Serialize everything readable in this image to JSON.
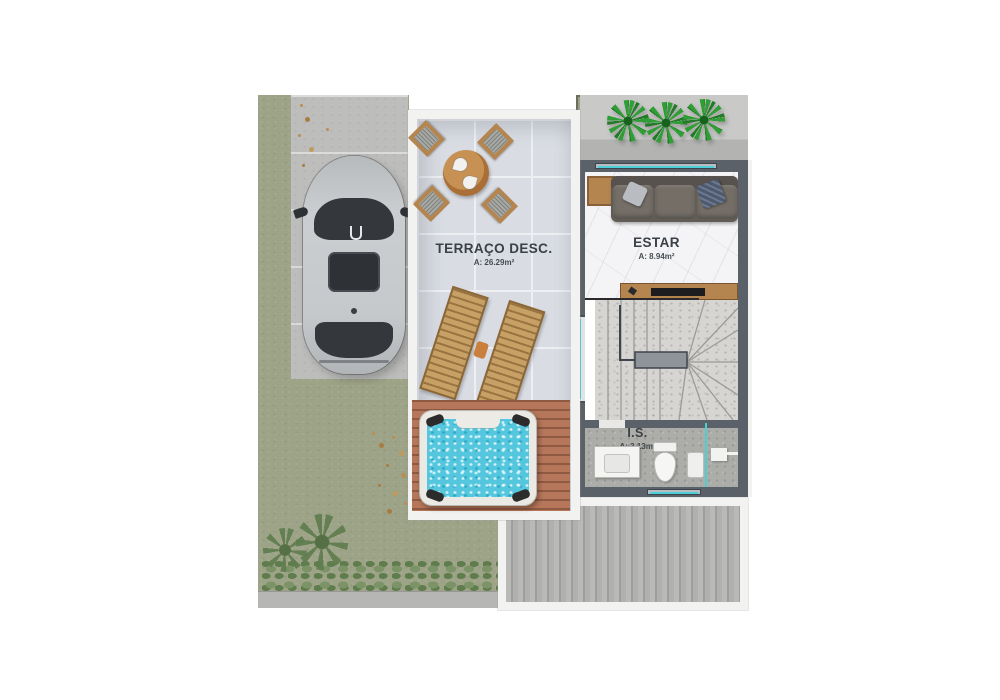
{
  "plan": {
    "type": "floor-plan",
    "rooms": [
      {
        "name": "TERRAÇO DESC.",
        "area": "A: 26.29m²"
      },
      {
        "name": "ESTAR",
        "area": "A: 8.94m²"
      },
      {
        "name": "I.S.",
        "area": "A: 3.13m²"
      }
    ],
    "objects": [
      "car",
      "dining-table-set",
      "sun-loungers",
      "jacuzzi",
      "sofa",
      "tv-console",
      "winder-staircase",
      "toilet",
      "vanity-sink",
      "shower",
      "potted-plants",
      "wood-deck",
      "lawn",
      "driveway",
      "hedge"
    ],
    "colors": {
      "background": "#ffffff",
      "lawn": "#9da387",
      "driveway": "#bdbdbb",
      "terrace_tile": "#d9dde3",
      "terrace_border": "#f2f2f0",
      "wall": "#5b6168",
      "glass": "#4ccfd6",
      "water": "#54c6de",
      "furniture_wood": "#b5854f",
      "jacuzzi_deck_wood": "#b5765a",
      "rear_deck": "#aaaaa8",
      "plant_green": "#2f9e35",
      "label_text": "#3a4045"
    }
  }
}
